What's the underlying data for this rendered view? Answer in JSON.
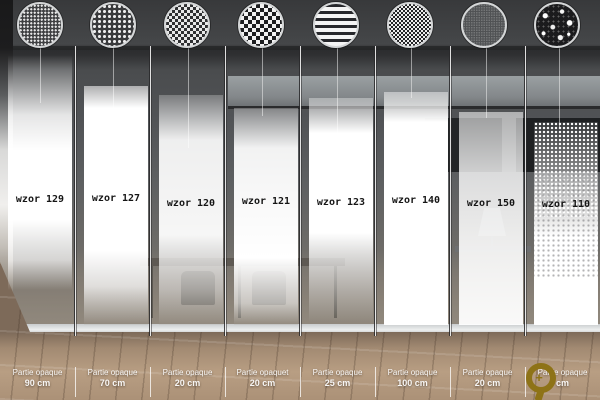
{
  "meta": {
    "description": "Catalog collage of eight frosted glass film patterns on office glazing",
    "language_pattern_word": "wzor",
    "colors": {
      "film_white": "#ffffff",
      "wall_dark": "#3c3d3f",
      "wood_floor": "#ab9177",
      "swatch_ring": "#d4d6d7",
      "caption_text": "#ffffff",
      "watermark_gold": "#8e7317",
      "wzor_label_text": "#151515"
    }
  },
  "columns": [
    {
      "wzor_label": "wzor 129",
      "pattern_icon": "fine-dot-grid-pattern",
      "caption_line1": "Partie opaque",
      "caption_line2": "90 cm"
    },
    {
      "wzor_label": "wzor 127",
      "pattern_icon": "dot-grid-pattern",
      "caption_line1": "Partie opaque",
      "caption_line2": "70 cm"
    },
    {
      "wzor_label": "wzor 120",
      "pattern_icon": "small-checker-pattern",
      "caption_line1": "Partie opaque",
      "caption_line2": "20 cm"
    },
    {
      "wzor_label": "wzor 121",
      "pattern_icon": "large-checker-pattern",
      "caption_line1": "Partie opaquet",
      "caption_line2": "20 cm"
    },
    {
      "wzor_label": "wzor 123",
      "pattern_icon": "horizontal-stripes-pattern",
      "caption_line1": "Partie opaque",
      "caption_line2": "25 cm"
    },
    {
      "wzor_label": "wzor 140",
      "pattern_icon": "fine-checker-pattern",
      "caption_line1": "Partie opaque",
      "caption_line2": "100 cm"
    },
    {
      "wzor_label": "wzor 150",
      "pattern_icon": "micro-grain-pattern",
      "caption_line1": "Partie opaque",
      "caption_line2": "20 cm"
    },
    {
      "wzor_label": "wzor 110",
      "pattern_icon": "random-speckle-pattern",
      "caption_line1": "Partie opaque",
      "caption_line2": "cm"
    }
  ],
  "watermark": {
    "icon": "zoom-magnifier-watermark",
    "glyph": "+"
  }
}
